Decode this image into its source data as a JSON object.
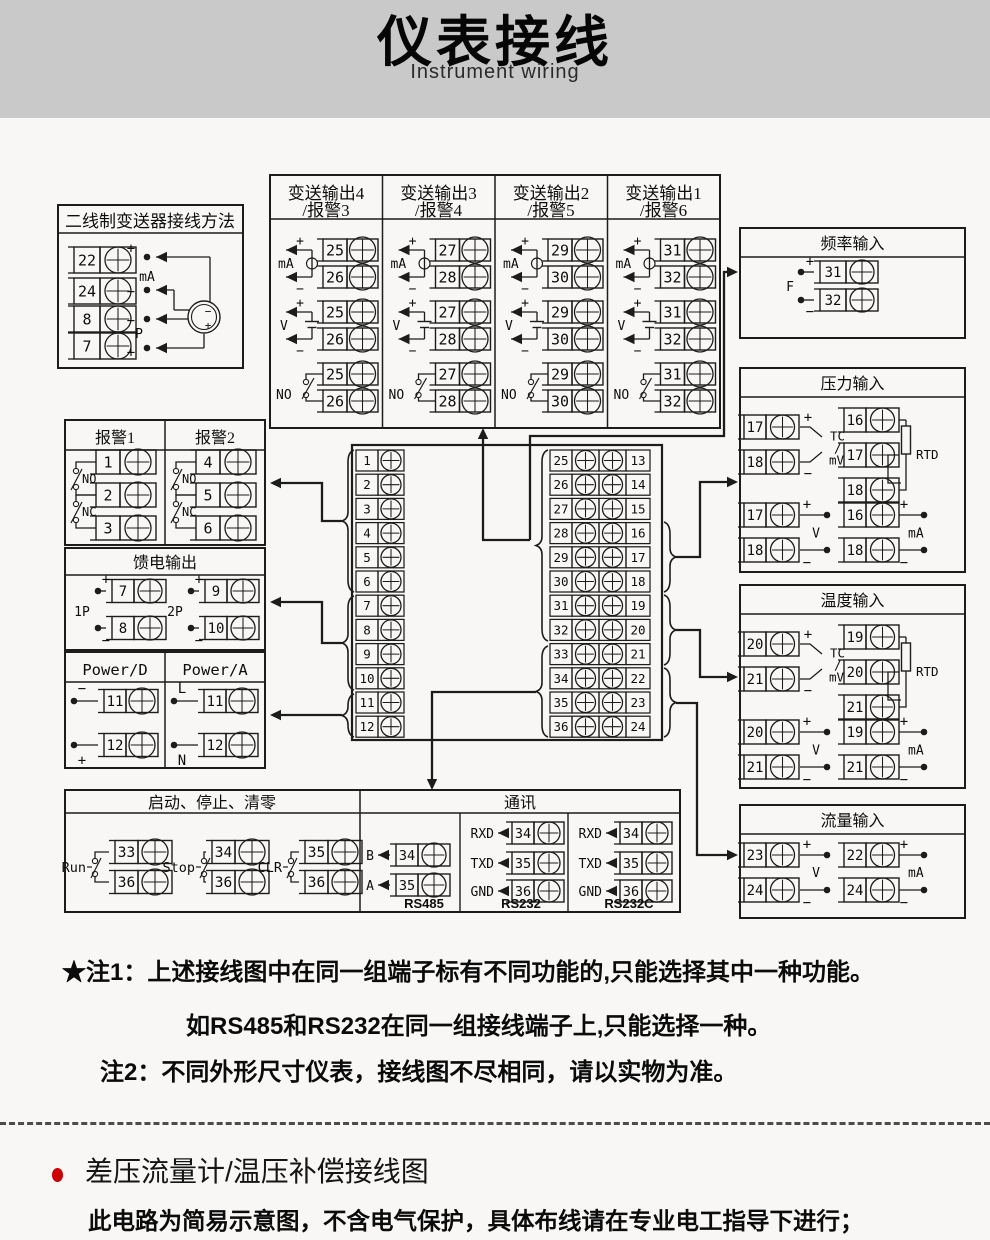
{
  "header": {
    "title": "仪表接线",
    "subtitle": "Instrument wiring"
  },
  "diagram": {
    "sym": {
      "plus": "+",
      "minus": "−",
      "ma": "mA",
      "v": "V",
      "no": "NO",
      "nc": "NC"
    },
    "two_wire": {
      "title": "二线制变送器接线方法",
      "terminals": [
        "22",
        "24",
        "8",
        "7"
      ],
      "p_label": "P"
    },
    "transmit_outputs": {
      "columns": [
        {
          "title_line1": "变送输出4",
          "title_line2": "/报警3",
          "pair": [
            "25",
            "26"
          ]
        },
        {
          "title_line1": "变送输出3",
          "title_line2": "/报警4",
          "pair": [
            "27",
            "28"
          ]
        },
        {
          "title_line1": "变送输出2",
          "title_line2": "/报警5",
          "pair": [
            "29",
            "30"
          ]
        },
        {
          "title_line1": "变送输出1",
          "title_line2": "/报警6",
          "pair": [
            "31",
            "32"
          ]
        }
      ]
    },
    "freq_input": {
      "title": "频率输入",
      "terminals": [
        "31",
        "32"
      ],
      "label": "F"
    },
    "pressure_input": {
      "title": "压力输入",
      "tc": {
        "terminals": [
          "17",
          "18"
        ],
        "label": [
          "TC",
          "/",
          "mV"
        ]
      },
      "rtd": {
        "terminals": [
          "16",
          "17",
          "18"
        ],
        "label": "RTD"
      },
      "v": {
        "terminals": [
          "17",
          "18"
        ],
        "label": "V"
      },
      "ma": {
        "terminals": [
          "16",
          "18"
        ],
        "label": "mA"
      }
    },
    "temp_input": {
      "title": "温度输入",
      "tc": {
        "terminals": [
          "20",
          "21"
        ],
        "label": [
          "TC",
          "/",
          "mV"
        ]
      },
      "rtd": {
        "terminals": [
          "19",
          "20",
          "21"
        ],
        "label": "RTD"
      },
      "v": {
        "terminals": [
          "20",
          "21"
        ],
        "label": "V"
      },
      "ma": {
        "terminals": [
          "19",
          "21"
        ],
        "label": "mA"
      }
    },
    "flow_input": {
      "title": "流量输入",
      "v": {
        "terminals": [
          "23",
          "24"
        ],
        "label": "V"
      },
      "ma": {
        "terminals": [
          "22",
          "24"
        ],
        "label": "mA"
      }
    },
    "alarms": {
      "columns": [
        {
          "title": "报警1",
          "terminals": [
            "1",
            "2",
            "3"
          ]
        },
        {
          "title": "报警2",
          "terminals": [
            "4",
            "5",
            "6"
          ]
        }
      ]
    },
    "feed_output": {
      "title": "馈电输出",
      "groups": [
        {
          "label": "1P",
          "terminals": [
            "7",
            "8"
          ]
        },
        {
          "label": "2P",
          "terminals": [
            "9",
            "10"
          ]
        }
      ]
    },
    "power": {
      "columns": [
        {
          "title": "Power/D",
          "rows": [
            {
              "label": "−",
              "terminal": "11"
            },
            {
              "label": "+",
              "terminal": "12"
            }
          ]
        },
        {
          "title": "Power/A",
          "rows": [
            {
              "label": "L",
              "terminal": "11"
            },
            {
              "label": "N",
              "terminal": "12"
            }
          ]
        }
      ]
    },
    "run_stop": {
      "title": "启动、停止、清零",
      "switches": [
        {
          "label": "Run",
          "terminals": [
            "33",
            "36"
          ]
        },
        {
          "label": "Stop",
          "terminals": [
            "34",
            "36"
          ]
        },
        {
          "label": "CLR",
          "terminals": [
            "35",
            "36"
          ]
        }
      ]
    },
    "comm": {
      "title": "通讯",
      "groups": [
        {
          "name": "RS485",
          "rows": [
            {
              "label": "B",
              "terminal": "34"
            },
            {
              "label": "A",
              "terminal": "35"
            }
          ]
        },
        {
          "name": "RS232",
          "rows": [
            {
              "label": "RXD",
              "terminal": "34"
            },
            {
              "label": "TXD",
              "terminal": "35"
            },
            {
              "label": "GND",
              "terminal": "36"
            }
          ]
        },
        {
          "name": "RS232C",
          "rows": [
            {
              "label": "RXD",
              "terminal": "34"
            },
            {
              "label": "TXD",
              "terminal": "35"
            },
            {
              "label": "GND",
              "terminal": "36"
            }
          ]
        }
      ]
    },
    "center_block": {
      "left": [
        "1",
        "2",
        "3",
        "4",
        "5",
        "6",
        "7",
        "8",
        "9",
        "10",
        "11",
        "12"
      ],
      "mid": [
        "25",
        "26",
        "27",
        "28",
        "29",
        "30",
        "31",
        "32",
        "33",
        "34",
        "35",
        "36"
      ],
      "right": [
        "13",
        "14",
        "15",
        "16",
        "17",
        "18",
        "19",
        "20",
        "21",
        "22",
        "23",
        "24"
      ]
    }
  },
  "notes": {
    "note1_label": "★注1：",
    "note1_line1": "上述接线图中在同一组端子标有不同功能的,只能选择其中一种功能。",
    "note1_line2": "如RS485和RS232在同一组接线端子上,只能选择一种。",
    "note2_label": "注2：",
    "note2_line": "不同外形尺寸仪表，接线图不尽相同，请以实物为准。"
  },
  "footer": {
    "heading": "差压流量计/温压补偿接线图",
    "body": "此电路为简易示意图，不含电气保护，具体布线请在专业电工指导下进行；",
    "bullet_color": "#cc0000"
  }
}
